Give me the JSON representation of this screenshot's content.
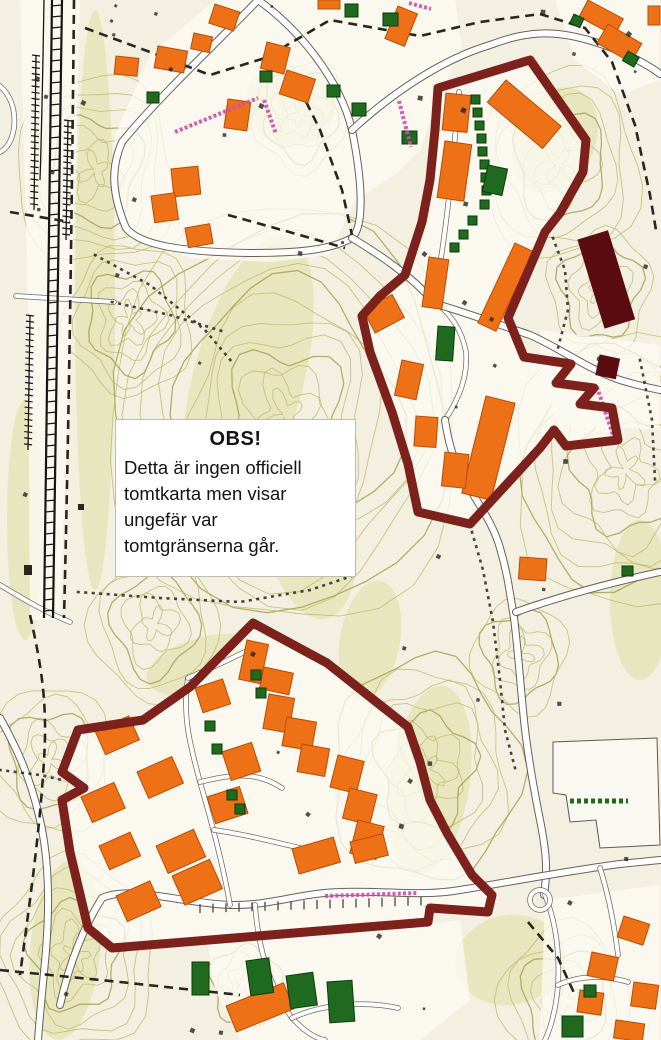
{
  "notice": {
    "title": "OBS!",
    "lines": [
      "Detta är ingen officiell",
      "tomtkarta men visar",
      "ungefär var",
      "tomtgränserna går."
    ]
  },
  "colors": {
    "map-bg": "#f3f0e1",
    "developed": "#fbfaf2",
    "contour": "#bcb967",
    "contour-strong": "#a6a251",
    "vegetation": "#d8da8e",
    "road-fill": "#ffffff",
    "road-casing": "#55524a",
    "building-orange": "#ee7118",
    "building-orange-outline": "#b94d03",
    "building-green": "#1f6a1f",
    "building-green-outline": "#0a3c0a",
    "building-maroon": "#5a0c10",
    "boundary-maroon": "#7d211d",
    "railway-black": "#161614",
    "path-black": "#26261f",
    "street-label-pink": "#cf4da8",
    "notice-bg": "#ffffff",
    "notice-border": "#bdbdb5",
    "notice-text": "#141414"
  }
}
